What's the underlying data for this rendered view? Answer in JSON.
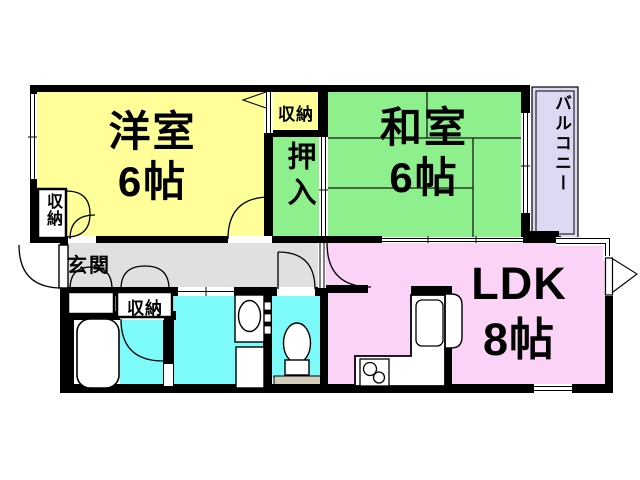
{
  "fp": {
    "rooms": {
      "western": {
        "name": "洋室",
        "size": "6帖",
        "color": "#ffff99"
      },
      "japanese": {
        "name": "和室",
        "size": "6帖",
        "color": "#8df08d"
      },
      "ldk": {
        "name": "LDK",
        "size": "8帖",
        "color": "#fbd3f6"
      },
      "balcony": {
        "name": "バルコニー",
        "color": "#ded8f2"
      },
      "entrance": {
        "name": "玄関",
        "color": "#e0e0e0"
      },
      "oshiire": {
        "name": "押入",
        "color": "#8df08d"
      },
      "storage_top": {
        "name": "収納",
        "color": "#ffff99"
      },
      "storage_bedroom": {
        "name": "収納",
        "color": "#ffffff"
      },
      "storage_hall": {
        "name": "収納",
        "color": "#ffffff"
      },
      "bathroom": {
        "color": "#7dfafa"
      },
      "washroom": {
        "color": "#7dfafa"
      },
      "toilet": {
        "color": "#7dfafa"
      }
    },
    "colors": {
      "wall": "#000000",
      "fixture": "#ffffff",
      "tan_strip": "#d4cfbd",
      "tatami_line": "#1a1a1a"
    },
    "fixtures": {
      "bathtub": "bathtub-icon",
      "washbasin": "washbasin-icon",
      "washing_machine": "washing-machine-icon",
      "toilet_bowl": "toilet-icon",
      "kitchen_counter": "kitchen-counter-icon",
      "kitchen_sink": "sink-icon",
      "stove": "stove-2-burner-icon"
    }
  }
}
